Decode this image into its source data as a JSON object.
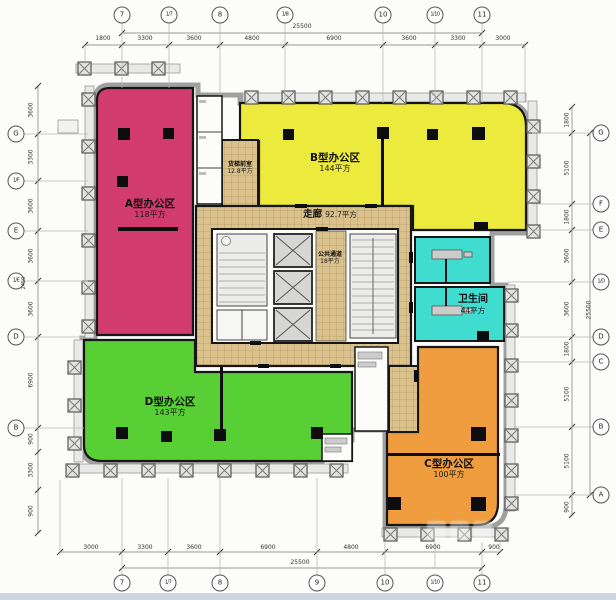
{
  "plan": {
    "rooms": {
      "zone_a": {
        "name": "A型办公区",
        "area": "118平方"
      },
      "zone_b": {
        "name": "B型办公区",
        "area": "144平方"
      },
      "zone_c": {
        "name": "C型办公区",
        "area": "100平方"
      },
      "zone_d": {
        "name": "D型办公区",
        "area": "143平方"
      },
      "corridor": {
        "name": "走廊",
        "area": "92.7平方"
      },
      "public_passage": {
        "name": "公共通道",
        "area": "18平方"
      },
      "freight_lobby": {
        "name": "货梯前室",
        "area": "12.8平方"
      },
      "restroom": {
        "name": "卫生间",
        "area": "44平方"
      }
    },
    "colors": {
      "zone_a": "#d23b6e",
      "zone_b": "#edea3e",
      "zone_c": "#f09d3f",
      "zone_d": "#59cf36",
      "restroom": "#41dcd0",
      "corridor_tile": "#dbc28c"
    },
    "grid": {
      "top": {
        "axes": [
          "7",
          "1/7",
          "8",
          "1/8",
          "10",
          "1/10",
          "11"
        ],
        "dims": [
          "1800",
          "3300",
          "3600",
          "4800",
          "6900",
          "3600",
          "3300",
          "3000"
        ],
        "overall": "25500"
      },
      "bottom": {
        "axes": [
          "7",
          "1/7",
          "8",
          "9",
          "10",
          "1/10",
          "11"
        ],
        "dims": [
          "3000",
          "3300",
          "3600",
          "6900",
          "4800",
          "6900",
          "900"
        ],
        "overall": "25500"
      },
      "left": {
        "axes": [
          "G",
          "1/F",
          "E",
          "1/E",
          "D",
          "B"
        ],
        "dims": [
          "3600",
          "3300",
          "3600",
          "3600",
          "3600",
          "6900",
          "900",
          "3300",
          "900"
        ],
        "note": "2450"
      },
      "right": {
        "axes": [
          "G",
          "F",
          "E",
          "1/D",
          "D",
          "C",
          "B",
          "A"
        ],
        "dims": [
          "1800",
          "5100",
          "1800",
          "3600",
          "3600",
          "1800",
          "5100",
          "5100",
          "900"
        ],
        "overall": "25500"
      }
    }
  }
}
